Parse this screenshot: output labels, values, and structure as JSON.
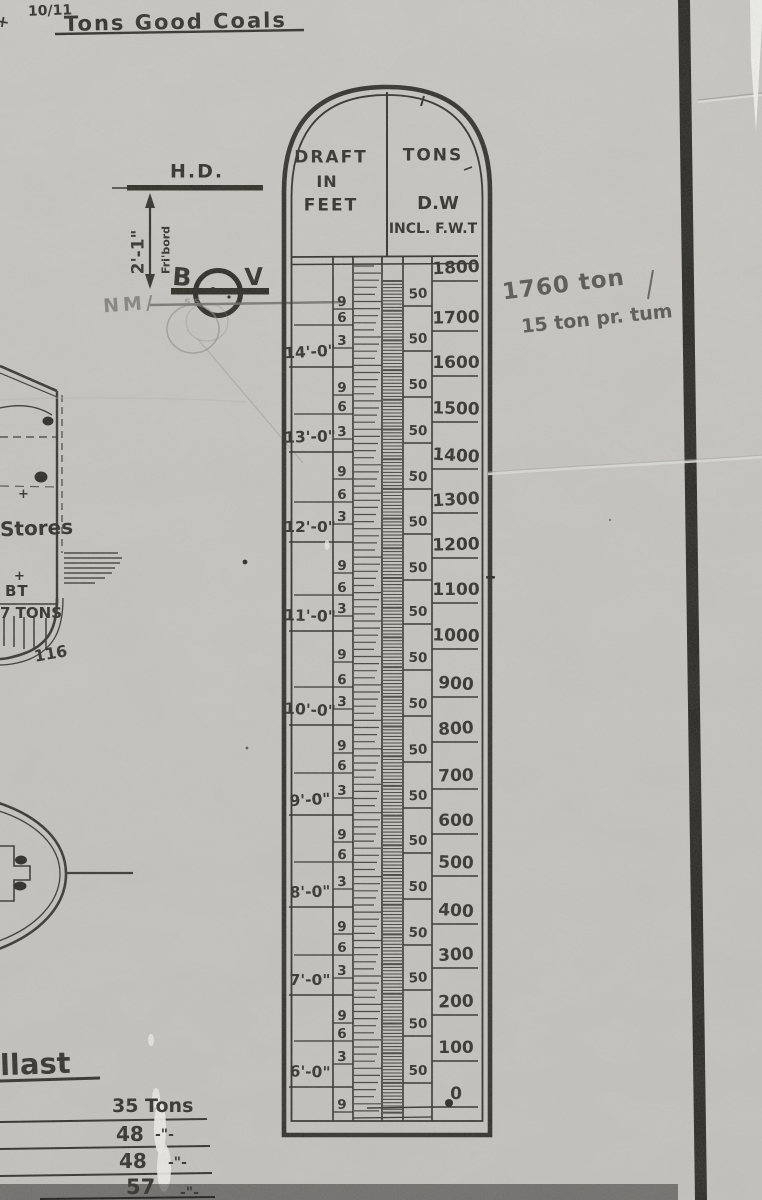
{
  "top_note": {
    "prefix": "+",
    "fraction": "10/11",
    "text": "Tons Good Coals"
  },
  "pencil_note": {
    "line1": "1760 ton",
    "line2": "15 ton pr. tum"
  },
  "freeboard_annotation": {
    "hd": "H.D.",
    "dimension": "2'-1\"",
    "fribord": "Fri'bord",
    "b": "B",
    "v": "V",
    "nm": "NM/",
    "s_marks": "s s"
  },
  "hull_sketch": {
    "stores": "Stores",
    "bt": "BT",
    "tons": "7 TONS",
    "frame": "116",
    "plus_upper": "+",
    "plus_lower": "+"
  },
  "ballast": {
    "heading": "llast",
    "rows": [
      {
        "value": "35 Tons",
        "ditto": ""
      },
      {
        "value": "48",
        "ditto": "-\"-"
      },
      {
        "value": "48",
        "ditto": "-\"-"
      },
      {
        "value": "57",
        "ditto": "-\"-"
      }
    ]
  },
  "scale": {
    "header": {
      "left1": "DRAFT",
      "left2": "IN",
      "left3": "FEET",
      "right1": "TONS",
      "right2": "D.W",
      "right3": "INCL. F.W.T"
    },
    "draft_feet": [
      {
        "label": "14'-0\"",
        "y": 352
      },
      {
        "label": "13'-0\"",
        "y": 437
      },
      {
        "label": "12'-0\"",
        "y": 527
      },
      {
        "label": "11'-0\"",
        "y": 616
      },
      {
        "label": "10'-0\"",
        "y": 710
      },
      {
        "label": "9'-0\"",
        "y": 800
      },
      {
        "label": "8'-0\"",
        "y": 892
      },
      {
        "label": "7'-0\"",
        "y": 980
      },
      {
        "label": "6'-0\"",
        "y": 1072
      }
    ],
    "inch_marks": [
      {
        "t": "9",
        "y": 302
      },
      {
        "t": "6",
        "y": 318
      },
      {
        "t": "3",
        "y": 341
      },
      {
        "t": "9",
        "y": 388
      },
      {
        "t": "6",
        "y": 407
      },
      {
        "t": "3",
        "y": 432
      },
      {
        "t": "9",
        "y": 472
      },
      {
        "t": "6",
        "y": 495
      },
      {
        "t": "3",
        "y": 517
      },
      {
        "t": "9",
        "y": 566
      },
      {
        "t": "6",
        "y": 588
      },
      {
        "t": "3",
        "y": 609
      },
      {
        "t": "9",
        "y": 655
      },
      {
        "t": "6",
        "y": 680
      },
      {
        "t": "3",
        "y": 702
      },
      {
        "t": "9",
        "y": 746
      },
      {
        "t": "6",
        "y": 766
      },
      {
        "t": "3",
        "y": 791
      },
      {
        "t": "9",
        "y": 835
      },
      {
        "t": "6",
        "y": 855
      },
      {
        "t": "3",
        "y": 882
      },
      {
        "t": "9",
        "y": 927
      },
      {
        "t": "6",
        "y": 948
      },
      {
        "t": "3",
        "y": 971
      },
      {
        "t": "9",
        "y": 1016
      },
      {
        "t": "6",
        "y": 1034
      },
      {
        "t": "3",
        "y": 1057
      },
      {
        "t": "9",
        "y": 1105
      }
    ],
    "tons": [
      {
        "t": "1800",
        "y": 268
      },
      {
        "t": "1700",
        "y": 318
      },
      {
        "t": "1600",
        "y": 363
      },
      {
        "t": "1500",
        "y": 409
      },
      {
        "t": "1400",
        "y": 456
      },
      {
        "t": "1300",
        "y": 500
      },
      {
        "t": "1200",
        "y": 545
      },
      {
        "t": "1100",
        "y": 590
      },
      {
        "t": "1000",
        "y": 636
      },
      {
        "t": "900",
        "y": 684
      },
      {
        "t": "800",
        "y": 729
      },
      {
        "t": "700",
        "y": 776
      },
      {
        "t": "600",
        "y": 821
      },
      {
        "t": "500",
        "y": 863
      },
      {
        "t": "400",
        "y": 911
      },
      {
        "t": "300",
        "y": 955
      },
      {
        "t": "200",
        "y": 1002
      },
      {
        "t": "100",
        "y": 1048
      },
      {
        "t": "0",
        "y": 1094
      }
    ],
    "fifties": [
      {
        "t": "50",
        "y": 294
      },
      {
        "t": "50",
        "y": 339
      },
      {
        "t": "50",
        "y": 385
      },
      {
        "t": "50",
        "y": 431
      },
      {
        "t": "50",
        "y": 477
      },
      {
        "t": "50",
        "y": 522
      },
      {
        "t": "50",
        "y": 568
      },
      {
        "t": "50",
        "y": 612
      },
      {
        "t": "50",
        "y": 658
      },
      {
        "t": "50",
        "y": 704
      },
      {
        "t": "50",
        "y": 750
      },
      {
        "t": "50",
        "y": 796
      },
      {
        "t": "50",
        "y": 841
      },
      {
        "t": "50",
        "y": 887
      },
      {
        "t": "50",
        "y": 933
      },
      {
        "t": "50",
        "y": 978
      },
      {
        "t": "50",
        "y": 1024
      },
      {
        "t": "50",
        "y": 1071
      }
    ]
  },
  "colors": {
    "paper": "#c9c8c4",
    "ink": "#2d2b27",
    "pencil": "#55544f",
    "band": "#232320"
  }
}
